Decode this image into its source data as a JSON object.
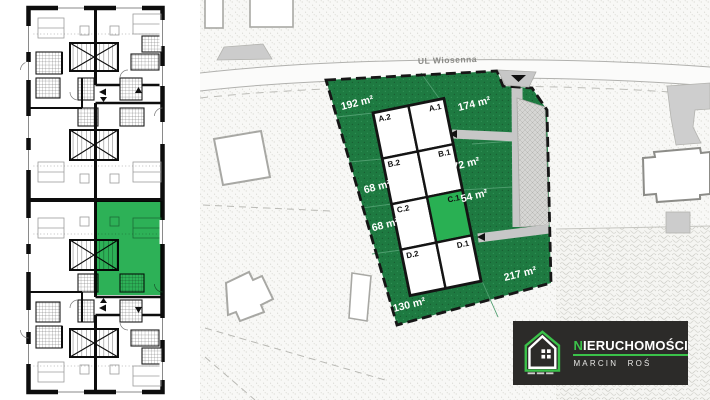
{
  "floor_plan": {
    "highlight_color": "#2db157"
  },
  "site_plan": {
    "street_label": "UL Wiosenna",
    "garden_color": "#1e7a41",
    "highlight_color": "#29b053",
    "boundary_color": "#161616",
    "driveway_color": "#c7c7c7",
    "units": [
      {
        "label": "A.2"
      },
      {
        "label": "A.1"
      },
      {
        "label": "B.2"
      },
      {
        "label": "B.1"
      },
      {
        "label": "C.2"
      },
      {
        "label": "C.1"
      },
      {
        "label": "D.2"
      },
      {
        "label": "D.1"
      }
    ],
    "areas": [
      {
        "text": "192 m²"
      },
      {
        "text": "174 m²"
      },
      {
        "text": "68 m²"
      },
      {
        "text": "72 m²"
      },
      {
        "text": "68 m²"
      },
      {
        "text": "54 m²"
      },
      {
        "text": "130 m²"
      },
      {
        "text": "217 m²"
      }
    ]
  },
  "logo": {
    "brand_first_letter": "N",
    "brand_rest": "IERUCHOMOŚCI",
    "subtitle": "MARCIN ROŚ",
    "background": "#2c2b29",
    "accent": "#3bc24a"
  }
}
